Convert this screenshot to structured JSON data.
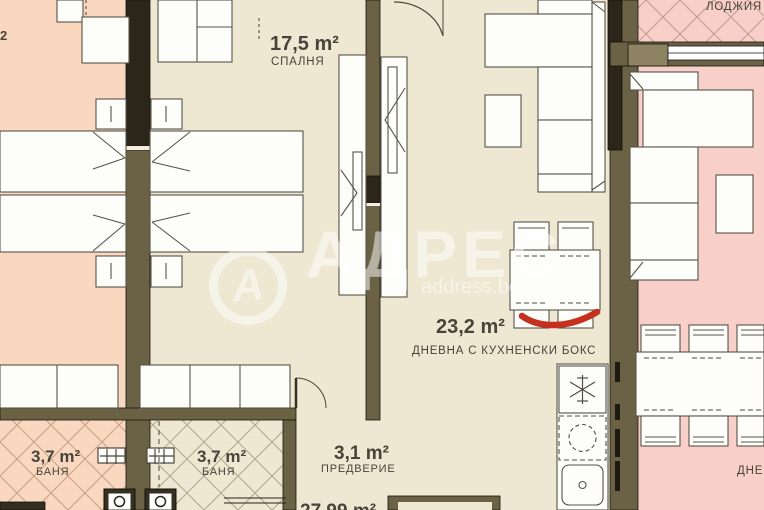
{
  "plan": {
    "watermark": {
      "logo_letter": "А",
      "brand": "АДРЕС",
      "site": "address.bg"
    },
    "rooms": {
      "bedroom": {
        "area": "17,5 m²",
        "name": "СПАЛНЯ"
      },
      "living_kitchen": {
        "area": "23,2 m²",
        "name": "ДНЕВНА С КУХНЕНСКИ БОКС"
      },
      "bathroom_left": {
        "area": "3,7 m²",
        "name": "БАНЯ"
      },
      "bathroom_right": {
        "area": "3,7 m²",
        "name": "БАНЯ"
      },
      "hallway": {
        "area": "3,1 m²",
        "name": "ПРЕДВЕРИЕ"
      },
      "loggia": {
        "name": "ЛОДЖИЯ"
      },
      "neighbor_right_living": {
        "name_partial": "ДНЕ"
      },
      "neighbor_left_area_fragment": "2",
      "bottom_area_fragment": "27,99 m²"
    },
    "annotations": {
      "red_marker": "hand-drawn red underline on dining table"
    },
    "colors": {
      "floor_left": "#f9d8bf",
      "floor_center": "#eee7d2",
      "floor_right": "#f8cfc9",
      "wall": "#6b6246",
      "wall_dark": "#2b2619",
      "furniture": "#fdfdfa",
      "label": "#47443a",
      "marker_red": "#c5301f",
      "watermark": "#ffffff"
    },
    "icons": {
      "fridge": "snowflake-icon",
      "hob": "dashed-circle-icon",
      "sink": "drain-icon",
      "toilet": "toilet-top-icon",
      "faucet": "cross-icon",
      "door": "swing-arc-icon"
    }
  }
}
